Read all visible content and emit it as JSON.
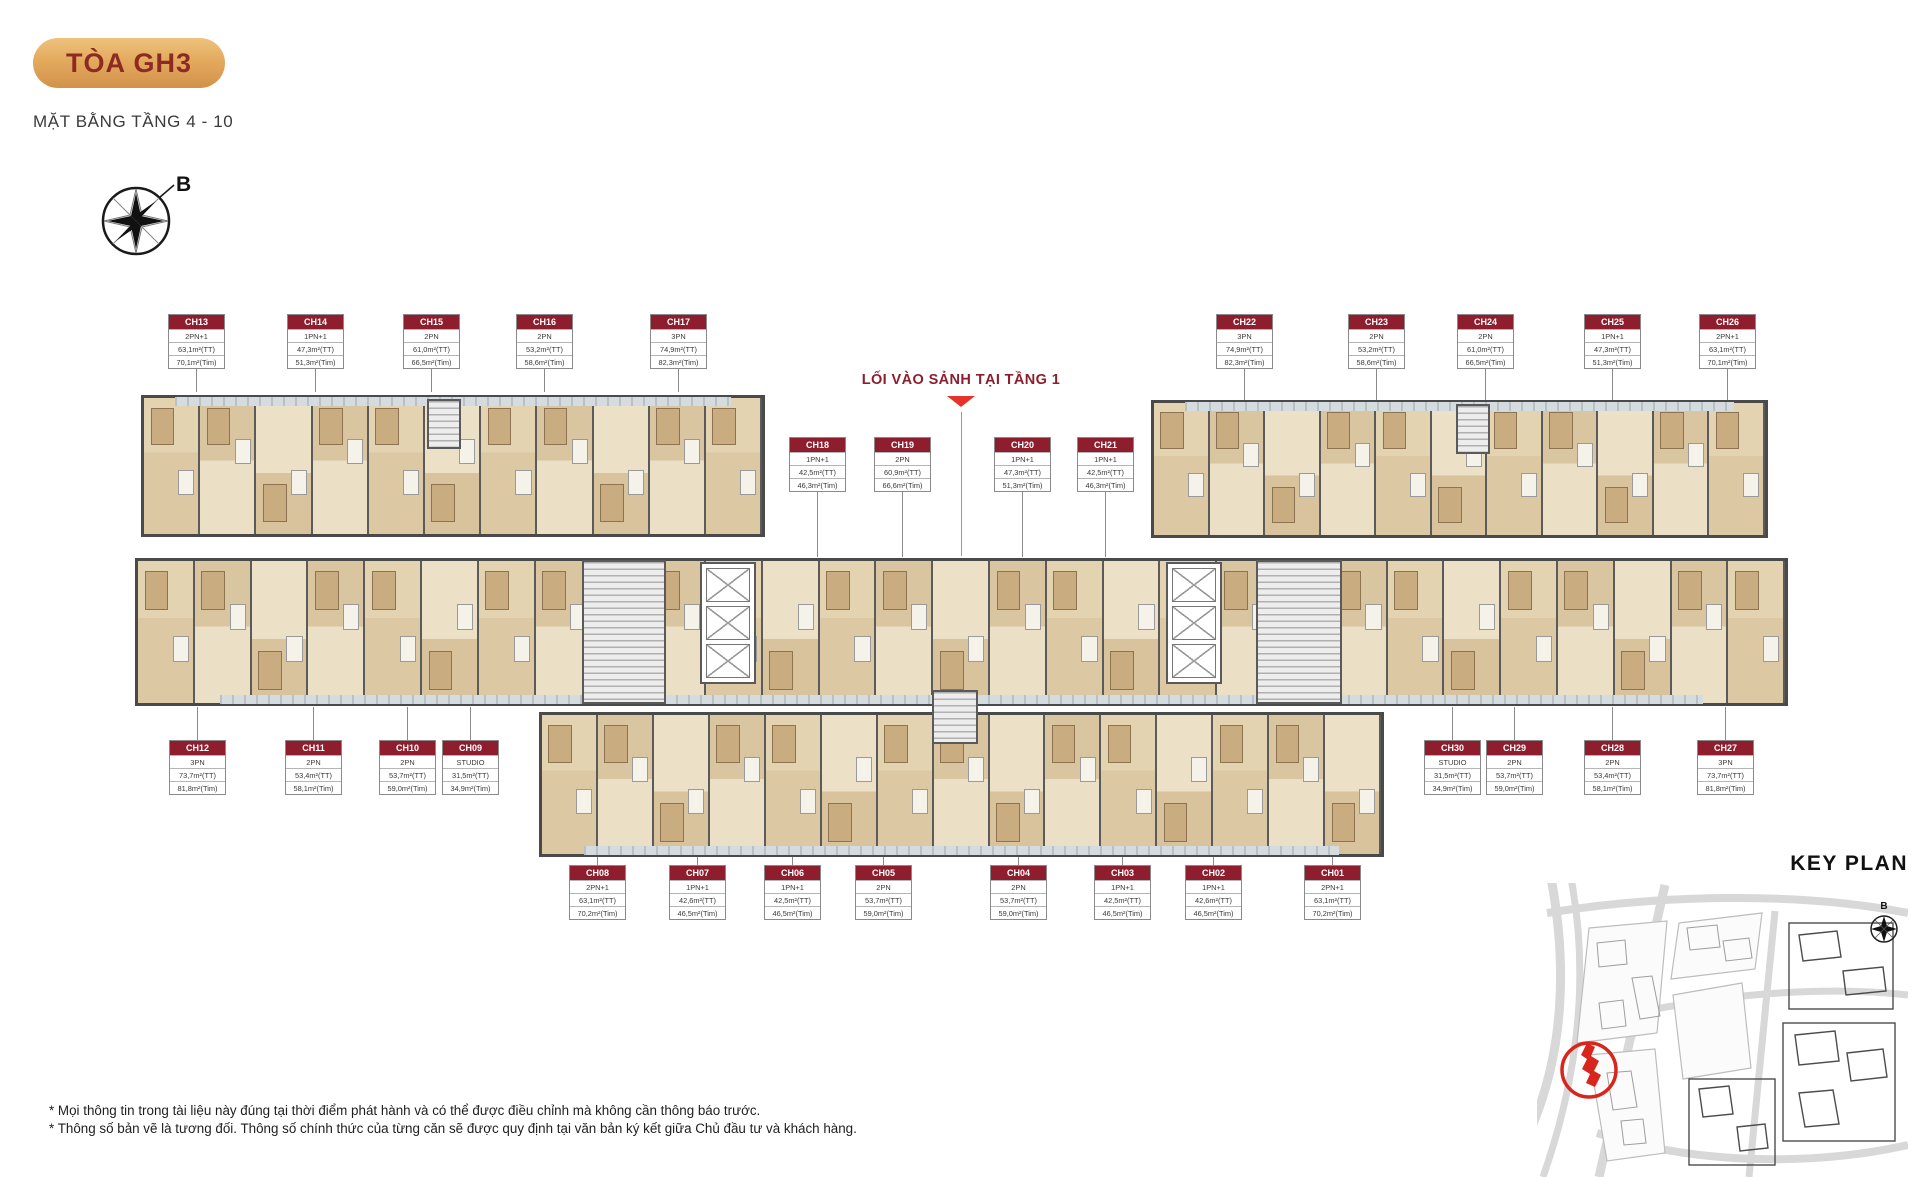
{
  "page": {
    "badge": "TÒA GH3",
    "subtitle": "MẶT BẰNG TẦNG 4 - 10",
    "compass_label": "B",
    "lobby_note": "LỐI VÀO SẢNH TẠI TẦNG 1",
    "key_plan_title": "KEY PLAN",
    "key_plan_compass_label": "B",
    "footnotes": [
      "* Mọi thông tin trong tài liệu này đúng tại thời điểm phát hành và có thể được điều chỉnh mà không cần thông báo trước.",
      "* Thông số bản vẽ là tương đối. Thông số chính thức của từng căn sẽ được quy định tại văn bản ký kết giữa Chủ đầu tư và khách hàng."
    ]
  },
  "colors": {
    "maroon": "#8e1e2e",
    "badge_gold": "#e3aa5e",
    "accent_red": "#e63229",
    "wall_gray": "#4a4a4a",
    "room_beige": "#e9ddc1",
    "wood": "#d9c5a0",
    "balcony_gray": "#b7c1c6"
  },
  "units": [
    {
      "id": "CH13",
      "type": "2PN+1",
      "area_tt": "63,1m²(TT)",
      "area_tim": "70,1m²(Tim)",
      "x": 196,
      "y": 314,
      "ly1": 360,
      "ly2": 392
    },
    {
      "id": "CH14",
      "type": "1PN+1",
      "area_tt": "47,3m²(TT)",
      "area_tim": "51,3m²(Tim)",
      "x": 315,
      "y": 314,
      "ly1": 360,
      "ly2": 392
    },
    {
      "id": "CH15",
      "type": "2PN",
      "area_tt": "61,0m²(TT)",
      "area_tim": "66,5m²(Tim)",
      "x": 431,
      "y": 314,
      "ly1": 360,
      "ly2": 392
    },
    {
      "id": "CH16",
      "type": "2PN",
      "area_tt": "53,2m²(TT)",
      "area_tim": "58,6m²(Tim)",
      "x": 544,
      "y": 314,
      "ly1": 360,
      "ly2": 392
    },
    {
      "id": "CH17",
      "type": "3PN",
      "area_tt": "74,9m²(TT)",
      "area_tim": "82,3m²(Tim)",
      "x": 678,
      "y": 314,
      "ly1": 360,
      "ly2": 392
    },
    {
      "id": "CH22",
      "type": "3PN",
      "area_tt": "74,9m²(TT)",
      "area_tim": "82,3m²(Tim)",
      "x": 1244,
      "y": 314,
      "ly1": 360,
      "ly2": 400
    },
    {
      "id": "CH23",
      "type": "2PN",
      "area_tt": "53,2m²(TT)",
      "area_tim": "58,6m²(Tim)",
      "x": 1376,
      "y": 314,
      "ly1": 360,
      "ly2": 400
    },
    {
      "id": "CH24",
      "type": "2PN",
      "area_tt": "61,0m²(TT)",
      "area_tim": "66,5m²(Tim)",
      "x": 1485,
      "y": 314,
      "ly1": 360,
      "ly2": 400
    },
    {
      "id": "CH25",
      "type": "1PN+1",
      "area_tt": "47,3m²(TT)",
      "area_tim": "51,3m²(Tim)",
      "x": 1612,
      "y": 314,
      "ly1": 360,
      "ly2": 400
    },
    {
      "id": "CH26",
      "type": "2PN+1",
      "area_tt": "63,1m²(TT)",
      "area_tim": "70,1m²(Tim)",
      "x": 1727,
      "y": 314,
      "ly1": 360,
      "ly2": 400
    },
    {
      "id": "CH18",
      "type": "1PN+1",
      "area_tt": "42,5m²(TT)",
      "area_tim": "46,3m²(Tim)",
      "x": 817,
      "y": 437,
      "ly1": 484,
      "ly2": 557
    },
    {
      "id": "CH19",
      "type": "2PN",
      "area_tt": "60,9m²(TT)",
      "area_tim": "66,6m²(Tim)",
      "x": 902,
      "y": 437,
      "ly1": 484,
      "ly2": 557
    },
    {
      "id": "CH20",
      "type": "1PN+1",
      "area_tt": "47,3m²(TT)",
      "area_tim": "51,3m²(Tim)",
      "x": 1022,
      "y": 437,
      "ly1": 484,
      "ly2": 557
    },
    {
      "id": "CH21",
      "type": "1PN+1",
      "area_tt": "42,5m²(TT)",
      "area_tim": "46,3m²(Tim)",
      "x": 1105,
      "y": 437,
      "ly1": 484,
      "ly2": 557
    },
    {
      "id": "CH12",
      "type": "3PN",
      "area_tt": "73,7m²(TT)",
      "area_tim": "81,8m²(Tim)",
      "x": 197,
      "y": 740,
      "ly1": 707,
      "ly2": 740
    },
    {
      "id": "CH11",
      "type": "2PN",
      "area_tt": "53,4m²(TT)",
      "area_tim": "58,1m²(Tim)",
      "x": 313,
      "y": 740,
      "ly1": 707,
      "ly2": 740
    },
    {
      "id": "CH10",
      "type": "2PN",
      "area_tt": "53,7m²(TT)",
      "area_tim": "59,0m²(Tim)",
      "x": 407,
      "y": 740,
      "ly1": 707,
      "ly2": 740
    },
    {
      "id": "CH09",
      "type": "STUDIO",
      "area_tt": "31,5m²(TT)",
      "area_tim": "34,9m²(Tim)",
      "x": 470,
      "y": 740,
      "ly1": 707,
      "ly2": 740
    },
    {
      "id": "CH30",
      "type": "STUDIO",
      "area_tt": "31,5m²(TT)",
      "area_tim": "34,9m²(Tim)",
      "x": 1452,
      "y": 740,
      "ly1": 707,
      "ly2": 740
    },
    {
      "id": "CH29",
      "type": "2PN",
      "area_tt": "53,7m²(TT)",
      "area_tim": "59,0m²(Tim)",
      "x": 1514,
      "y": 740,
      "ly1": 707,
      "ly2": 740
    },
    {
      "id": "CH28",
      "type": "2PN",
      "area_tt": "53,4m²(TT)",
      "area_tim": "58,1m²(Tim)",
      "x": 1612,
      "y": 740,
      "ly1": 707,
      "ly2": 740
    },
    {
      "id": "CH27",
      "type": "3PN",
      "area_tt": "73,7m²(TT)",
      "area_tim": "81,8m²(Tim)",
      "x": 1725,
      "y": 740,
      "ly1": 707,
      "ly2": 740
    },
    {
      "id": "CH08",
      "type": "2PN+1",
      "area_tt": "63,1m²(TT)",
      "area_tim": "70,2m²(Tim)",
      "x": 597,
      "y": 865,
      "ly1": 857,
      "ly2": 865
    },
    {
      "id": "CH07",
      "type": "1PN+1",
      "area_tt": "42,6m²(TT)",
      "area_tim": "46,5m²(Tim)",
      "x": 697,
      "y": 865,
      "ly1": 857,
      "ly2": 865
    },
    {
      "id": "CH06",
      "type": "1PN+1",
      "area_tt": "42,5m²(TT)",
      "area_tim": "46,5m²(Tim)",
      "x": 792,
      "y": 865,
      "ly1": 857,
      "ly2": 865
    },
    {
      "id": "CH05",
      "type": "2PN",
      "area_tt": "53,7m²(TT)",
      "area_tim": "59,0m²(Tim)",
      "x": 883,
      "y": 865,
      "ly1": 857,
      "ly2": 865
    },
    {
      "id": "CH04",
      "type": "2PN",
      "area_tt": "53,7m²(TT)",
      "area_tim": "59,0m²(Tim)",
      "x": 1018,
      "y": 865,
      "ly1": 857,
      "ly2": 865
    },
    {
      "id": "CH03",
      "type": "1PN+1",
      "area_tt": "42,5m²(TT)",
      "area_tim": "46,5m²(Tim)",
      "x": 1122,
      "y": 865,
      "ly1": 857,
      "ly2": 865
    },
    {
      "id": "CH02",
      "type": "1PN+1",
      "area_tt": "42,6m²(TT)",
      "area_tim": "46,5m²(Tim)",
      "x": 1213,
      "y": 865,
      "ly1": 857,
      "ly2": 865
    },
    {
      "id": "CH01",
      "type": "2PN+1",
      "area_tt": "63,1m²(TT)",
      "area_tim": "70,2m²(Tim)",
      "x": 1332,
      "y": 865,
      "ly1": 857,
      "ly2": 865
    }
  ]
}
